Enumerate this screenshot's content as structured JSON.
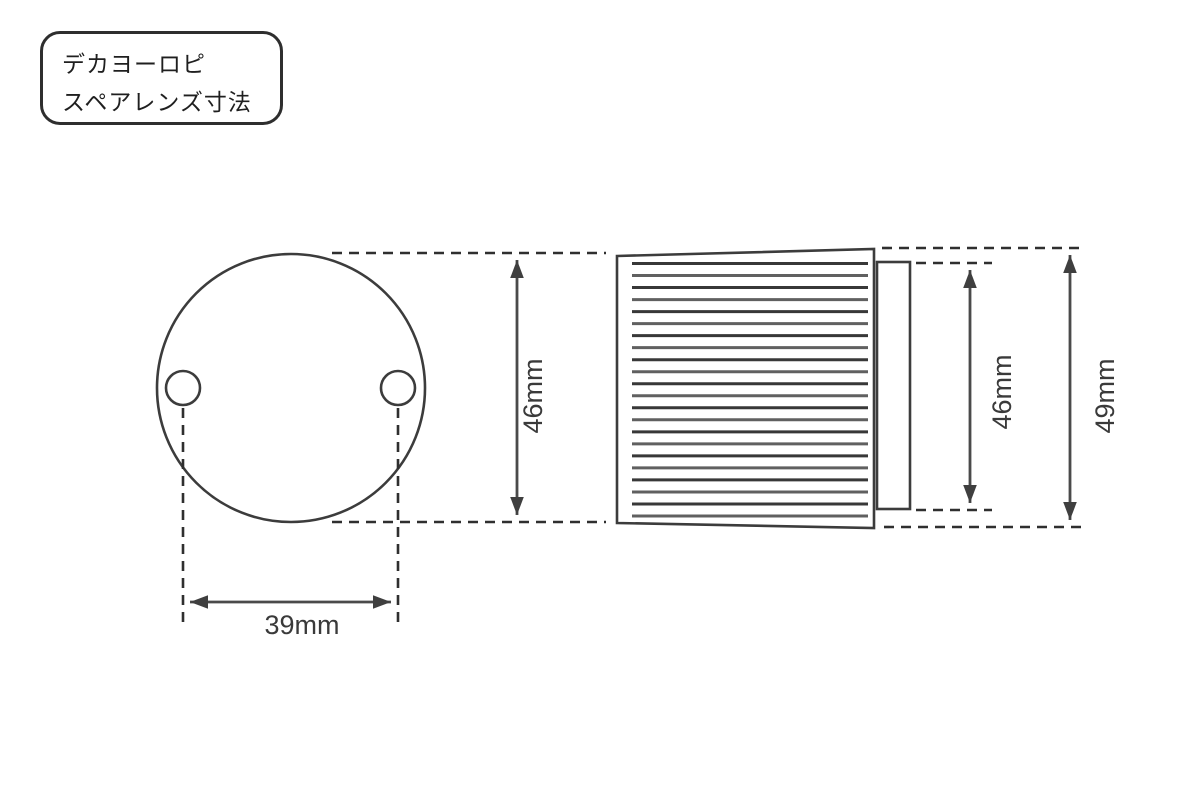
{
  "label_box": {
    "line1": "デカヨーロピ",
    "line2": "スペアレンズ寸法"
  },
  "dimensions": {
    "hole_spacing_width": "39mm",
    "front_diameter": "46mm",
    "rear_body_height": "46mm",
    "overall_height": "49mm"
  },
  "side_view": {
    "fin_count": 22
  },
  "colors": {
    "background": "#ffffff",
    "line": "#3c3c3c"
  }
}
